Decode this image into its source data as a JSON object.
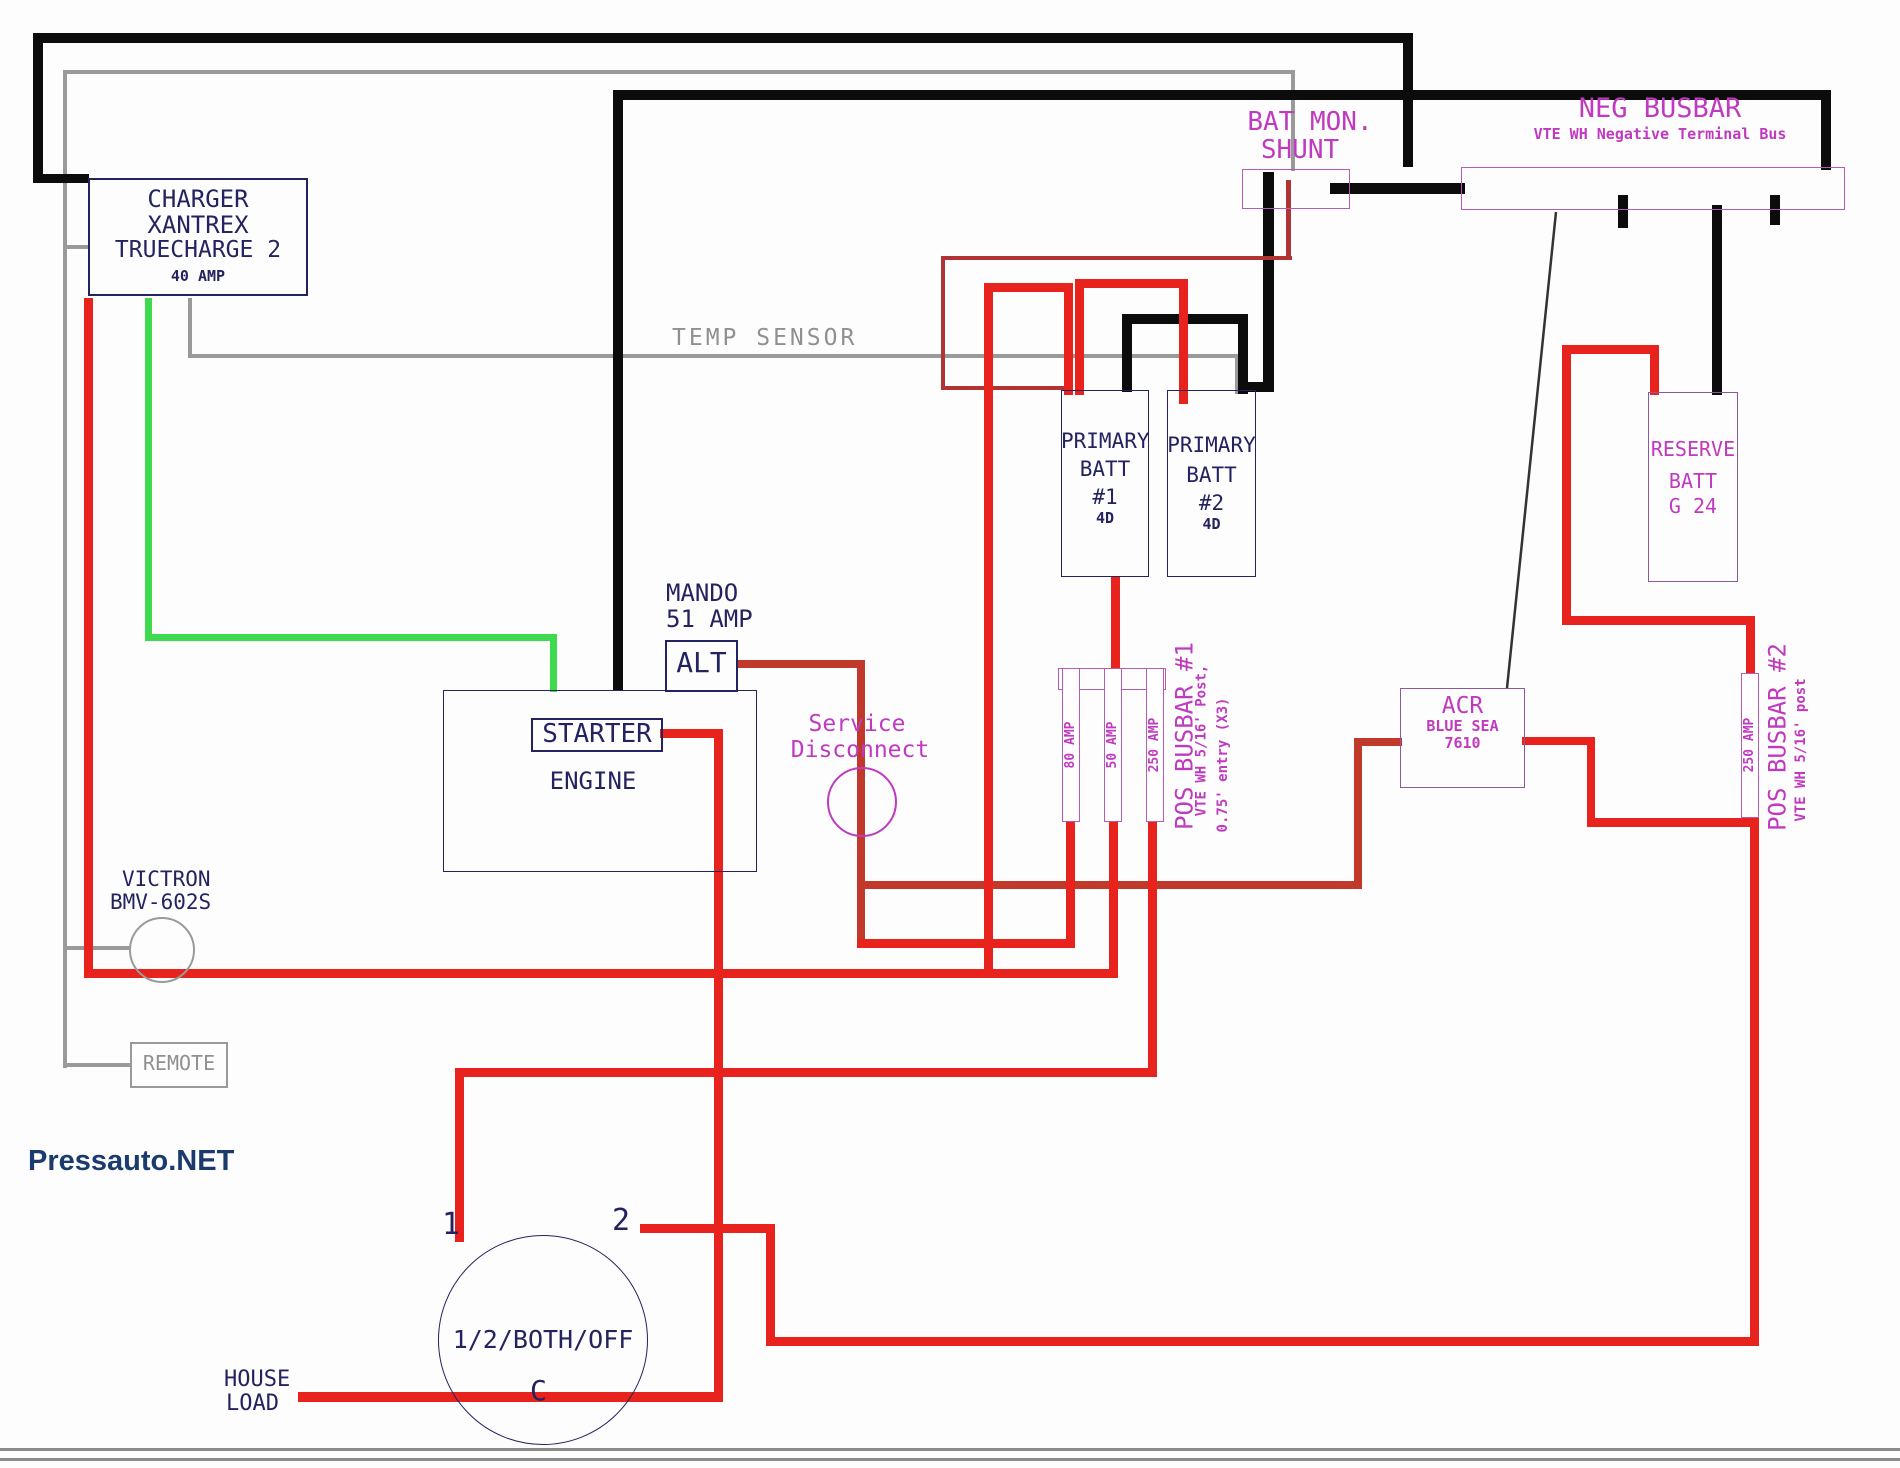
{
  "watermark": "Pressauto.NET",
  "charger": {
    "l1": "CHARGER",
    "l2": "XANTREX",
    "l3": "TRUECHARGE 2",
    "l4": "40 AMP"
  },
  "temp_sensor": "TEMP SENSOR",
  "bat_mon": {
    "l1": "BAT MON.",
    "l2": "SHUNT"
  },
  "neg_busbar": {
    "title": "NEG BUSBAR",
    "subtitle": "VTE WH Negative Terminal Bus"
  },
  "batt1": {
    "l1": "PRIMARY",
    "l2": "BATT",
    "l3": "#1",
    "l4": "4D"
  },
  "batt2": {
    "l1": "PRIMARY",
    "l2": "BATT",
    "l3": "#2",
    "l4": "4D"
  },
  "reserve": {
    "l1": "RESERVE",
    "l2": "BATT",
    "l3": "G 24"
  },
  "alternator": {
    "note1": "MANDO",
    "note2": "51 AMP",
    "label": "ALT"
  },
  "engine": {
    "starter": "STARTER",
    "engine": "ENGINE"
  },
  "service_disconnect": {
    "l1": "Service",
    "l2": "Disconnect"
  },
  "pos_busbar1": {
    "fuses": [
      "80 AMP",
      "50 AMP",
      "250 AMP"
    ],
    "title": "POS BUSBAR #1",
    "sub1": "VTE WH 5/16' Post,",
    "sub2": "0.75' entry (X3)"
  },
  "acr": {
    "l1": "ACR",
    "l2": "BLUE SEA",
    "l3": "7610"
  },
  "pos_busbar2": {
    "fuse": "250 AMP",
    "title": "POS BUSBAR #2",
    "sub1": "VTE WH 5/16' post"
  },
  "victron": {
    "l1": "VICTRON",
    "l2": "BMV-602S"
  },
  "remote": "REMOTE",
  "battery_switch": {
    "label": "1/2/BOTH/OFF",
    "t1": "1",
    "t2": "2",
    "tc": "C"
  },
  "house_load": {
    "l1": "HOUSE",
    "l2": "LOAD"
  },
  "colors": {
    "wire_positive": "#e8221c",
    "wire_positive_alt": "#c0392b",
    "wire_negative": "#0c0c0c",
    "wire_sense_gray": "#9a9a9a",
    "wire_charger_green": "#3fd94f",
    "label_magenta": "#c03ac0",
    "label_navy": "#232360",
    "watermark_blue": "#1b3b6e"
  }
}
